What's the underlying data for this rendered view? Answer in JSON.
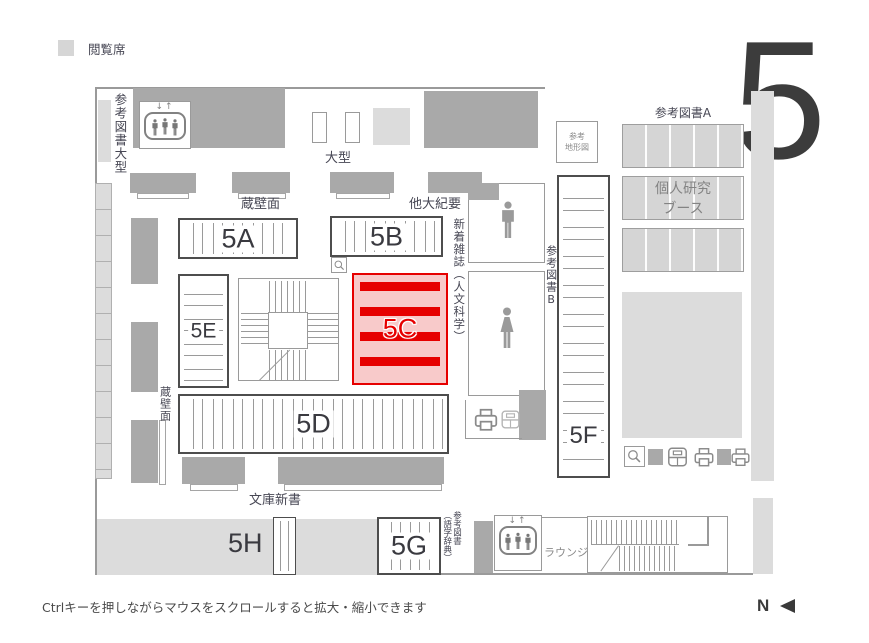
{
  "legend": {
    "label": "閲覧席",
    "swatch_color": "#d6d6d6"
  },
  "floor": {
    "big_number": "5"
  },
  "plan": {
    "areas": {
      "a5A": "5A",
      "a5B": "5B",
      "a5C": "5C",
      "a5D": "5D",
      "a5E": "5E",
      "a5F": "5F",
      "a5G": "5G",
      "a5H": "5H"
    },
    "labels": {
      "reference_books_large": "参考図書大型",
      "large_size": "大型",
      "wall_shelf_top": "蔵壁面",
      "other_univ_bulletins": "他大紀要",
      "new_magazines_humanities": "新着雑誌（人文科学）",
      "reference_maps_line1": "参考",
      "reference_maps_line2": "地形図",
      "reference_books_a": "参考図書A",
      "personal_booth_line1": "個人研究",
      "personal_booth_line2": "ブース",
      "reference_books_b": "参考図書B",
      "wall_shelf_left": "蔵壁面",
      "paperbacks": "文庫新書",
      "reference_books_dict_line1": "参考図書",
      "reference_books_dict_line2": "（語学辞典）",
      "lounge": "ラウンジ"
    },
    "elevator_arrows": "↓↑",
    "highlight": {
      "area": "5C",
      "fill": "#f8caca",
      "accent": "#e60000"
    },
    "colors": {
      "dark_block": "#a9a9a9",
      "light_block": "#dcdcdc",
      "wall": "#9a9a9a"
    },
    "icons": {
      "elevator": "rounded-square with three figures and ↓↑ arrows",
      "male_restroom": "man pictogram",
      "female_restroom": "woman pictogram",
      "magnifier": "search magnifier",
      "printer": "printer/copier",
      "reader": "device box with divider",
      "compass_arrow": "◄"
    }
  },
  "footer": {
    "hint": "Ctrlキーを押しながらマウスをスクロールすると拡大・縮小できます",
    "compass_label": "N"
  }
}
